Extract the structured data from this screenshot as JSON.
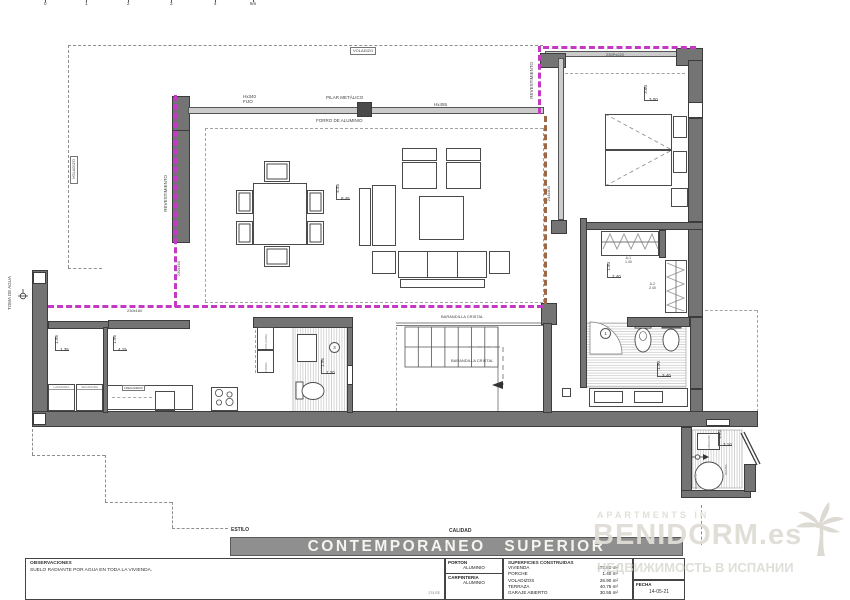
{
  "ruler": {
    "ticks": [
      "0",
      "1",
      "2",
      "3",
      "4",
      "5m"
    ]
  },
  "plan": {
    "labels": {
      "voladizo_top": "VOLADIZO",
      "voladizo_left": "VOLADIZO",
      "hx340": "Hx340",
      "fijo": "FIJO",
      "pilar_metalico": "PILAR METÁLICO",
      "hx455": "Hx455",
      "forro_aluminio": "FORRO DE ALUMINIO",
      "revestimiento_left": "REVESTIMIENTO",
      "revestimiento_right": "REVESTIMIENTO",
      "toma_de_agua": "TOMA DE AGUA",
      "window_230x160_v": "230x160",
      "window_230x160_h": "230x160",
      "window_230px220": "230Px220",
      "door_244x400": "244x400",
      "barandilla_cristal_1": "BARANDILLA CRISTAL",
      "barandilla_cristal_2": "BARANDILLA CRISTAL",
      "armario_a1": "A-1",
      "armario_a1_size": "1.40",
      "armario_a2": "A-2",
      "armario_a2_size": "2.40",
      "bath_ref": "1",
      "aseo_ref": "3",
      "lavadora": "LAVADORA",
      "secadora": "SECADORA",
      "fregadero": "FREGADERO",
      "columna": "COLUMNA",
      "frigorifico": "FRIGO.",
      "armario_tech": "ARMARIO",
      "deposito": "DEPOSITO",
      "bomba": "BOMBA"
    },
    "dims": {
      "living": {
        "v": "4.45",
        "h": "8.45"
      },
      "bedroom": {
        "v": "3.60",
        "h": "3.00"
      },
      "closet": {
        "v": "1.40",
        "h": "2.40"
      },
      "bath": {
        "v": "1.90",
        "h": "3.40"
      },
      "laundry": {
        "v": "1.95",
        "h": "1.35"
      },
      "kitchen": {
        "v": "1.95",
        "h": "4.15"
      },
      "aseo": {
        "v": "1.95",
        "h": "1.20"
      },
      "tech": {
        "v": "1.50",
        "h": "3.10"
      }
    }
  },
  "titleblock": {
    "estilo_label": "ESTILO",
    "calidad_label": "CALIDAD",
    "style_value": "CONTEMPORANEO SUPERIOR",
    "observaciones_label": "OBSERVACIONES",
    "observaciones_text": "SUELO RADIANTE POR AGUA EN TODA LA VIVIENDA.",
    "porton_label": "PORTON",
    "porton_value": "ALUMINIO",
    "carpinteria_label": "CARPINTERIA",
    "carpinteria_value": "ALUMINIO",
    "superficies_label": "SUPERFICIES CONSTRUIDAS",
    "superficies": [
      {
        "name": "VIVIENDA",
        "value": "170.80 m²"
      },
      {
        "name": "PORCHE",
        "value": "1.40 m²"
      },
      {
        "name": "VOLADIZOS",
        "value": "26.90 m²"
      },
      {
        "name": "TERRAZA",
        "value": "40.75 m²"
      },
      {
        "name": "GARAJE ABIERTO",
        "value": "30.55 m²"
      }
    ],
    "fecha_label": "FECHA",
    "fecha_value": "14-05-21",
    "ref_code": "274 EE"
  },
  "watermark": {
    "line1": "APARTMENTS IN",
    "brand": "BENIDORM.es",
    "line2": "НЕДВИЖИМОСТЬ В ИСПАНИИ"
  }
}
